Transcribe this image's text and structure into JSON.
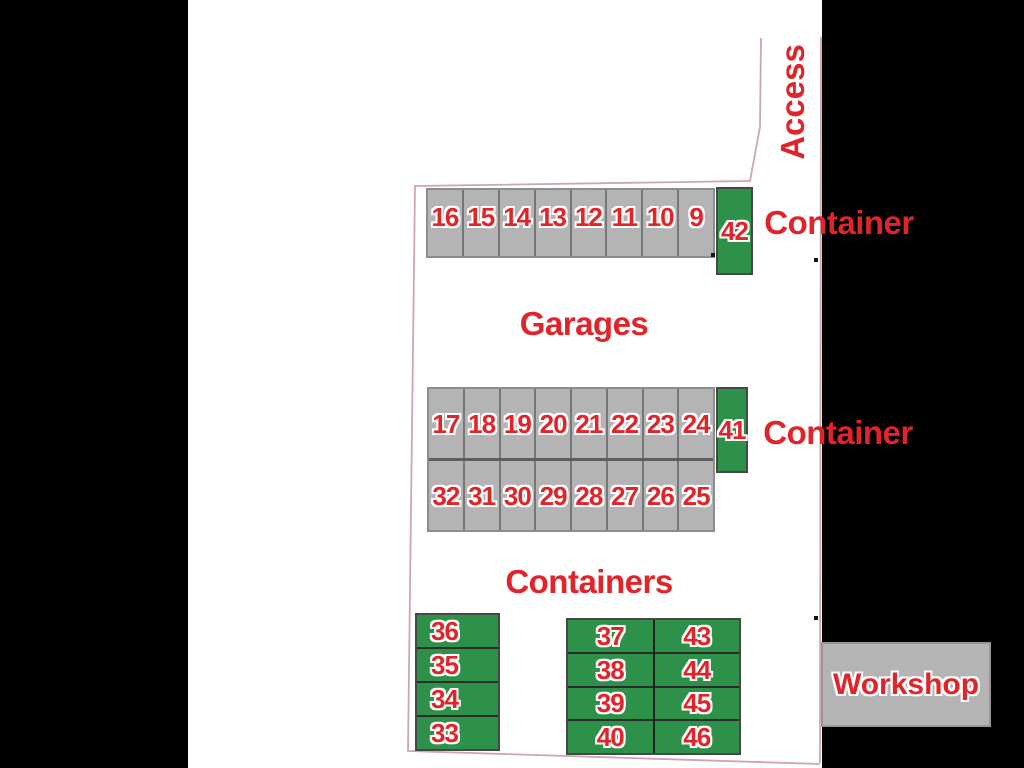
{
  "plan": {
    "access_label": "Access",
    "garages_label": "Garages",
    "containers_label": "Containers",
    "workshop_label": "Workshop",
    "container_label_top": "Container",
    "container_label_mid": "Container",
    "garage_row_top": [
      "16",
      "15",
      "14",
      "13",
      "12",
      "11",
      "10",
      "9"
    ],
    "garage_row_mid_upper": [
      "17",
      "18",
      "19",
      "20",
      "21",
      "22",
      "23",
      "24"
    ],
    "garage_row_mid_lower": [
      "32",
      "31",
      "30",
      "29",
      "28",
      "27",
      "26",
      "25"
    ],
    "container_42": "42",
    "container_41": "41",
    "containers_left": [
      "36",
      "35",
      "34",
      "33"
    ],
    "containers_mid_col1": [
      "37",
      "38",
      "39",
      "40"
    ],
    "containers_mid_col2": [
      "43",
      "44",
      "45",
      "46"
    ],
    "colors": {
      "label_red": "#e0242a",
      "container_green": "#2e9149",
      "garage_gray": "#b4b4b4",
      "boundary_pink": "#d0a3b6"
    }
  }
}
